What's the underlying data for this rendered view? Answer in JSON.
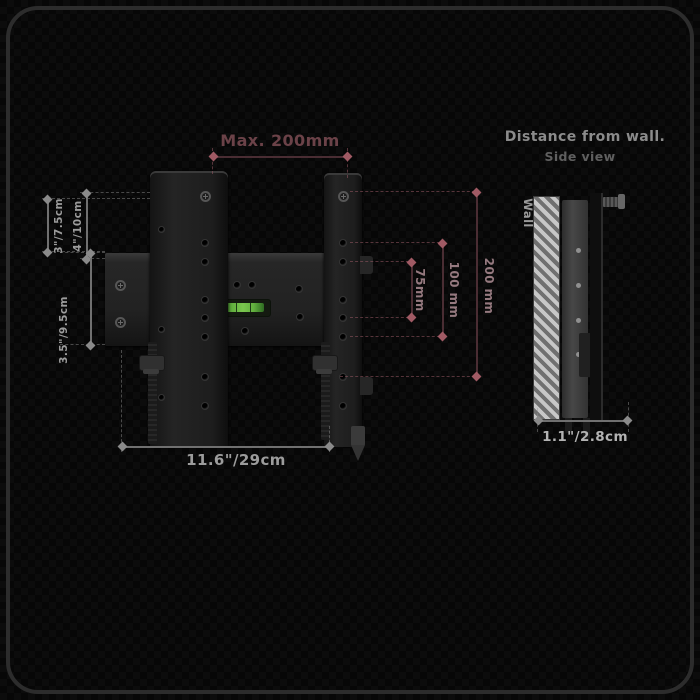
{
  "front_view": {
    "dim_top": "Max. 200mm",
    "dim_right_200": "200 mm",
    "dim_right_100": "100 mm",
    "dim_right_75": "75mm",
    "dim_left_a": "3\"/7.5cm",
    "dim_left_b": "4\"/10cm",
    "dim_left_c": "3.5\"/9.5cm",
    "dim_bottom": "11.6\"/29cm"
  },
  "side_view": {
    "title": "Distance from wall.",
    "subtitle": "Side view",
    "wall_label": "Wall",
    "dim_bottom": "1.1\"/2.8cm"
  },
  "colors": {
    "dim_red_line": "#4a2d33",
    "dim_red_arrow": "#a05a64",
    "dim_red_text": "#6b4248",
    "dim_red_label": "#95797f",
    "dim_gray_line": "#707070",
    "dim_gray_arrow": "#8a8a8a",
    "dim_gray_text": "#9c9c9c",
    "level_green": "#63b03f"
  }
}
